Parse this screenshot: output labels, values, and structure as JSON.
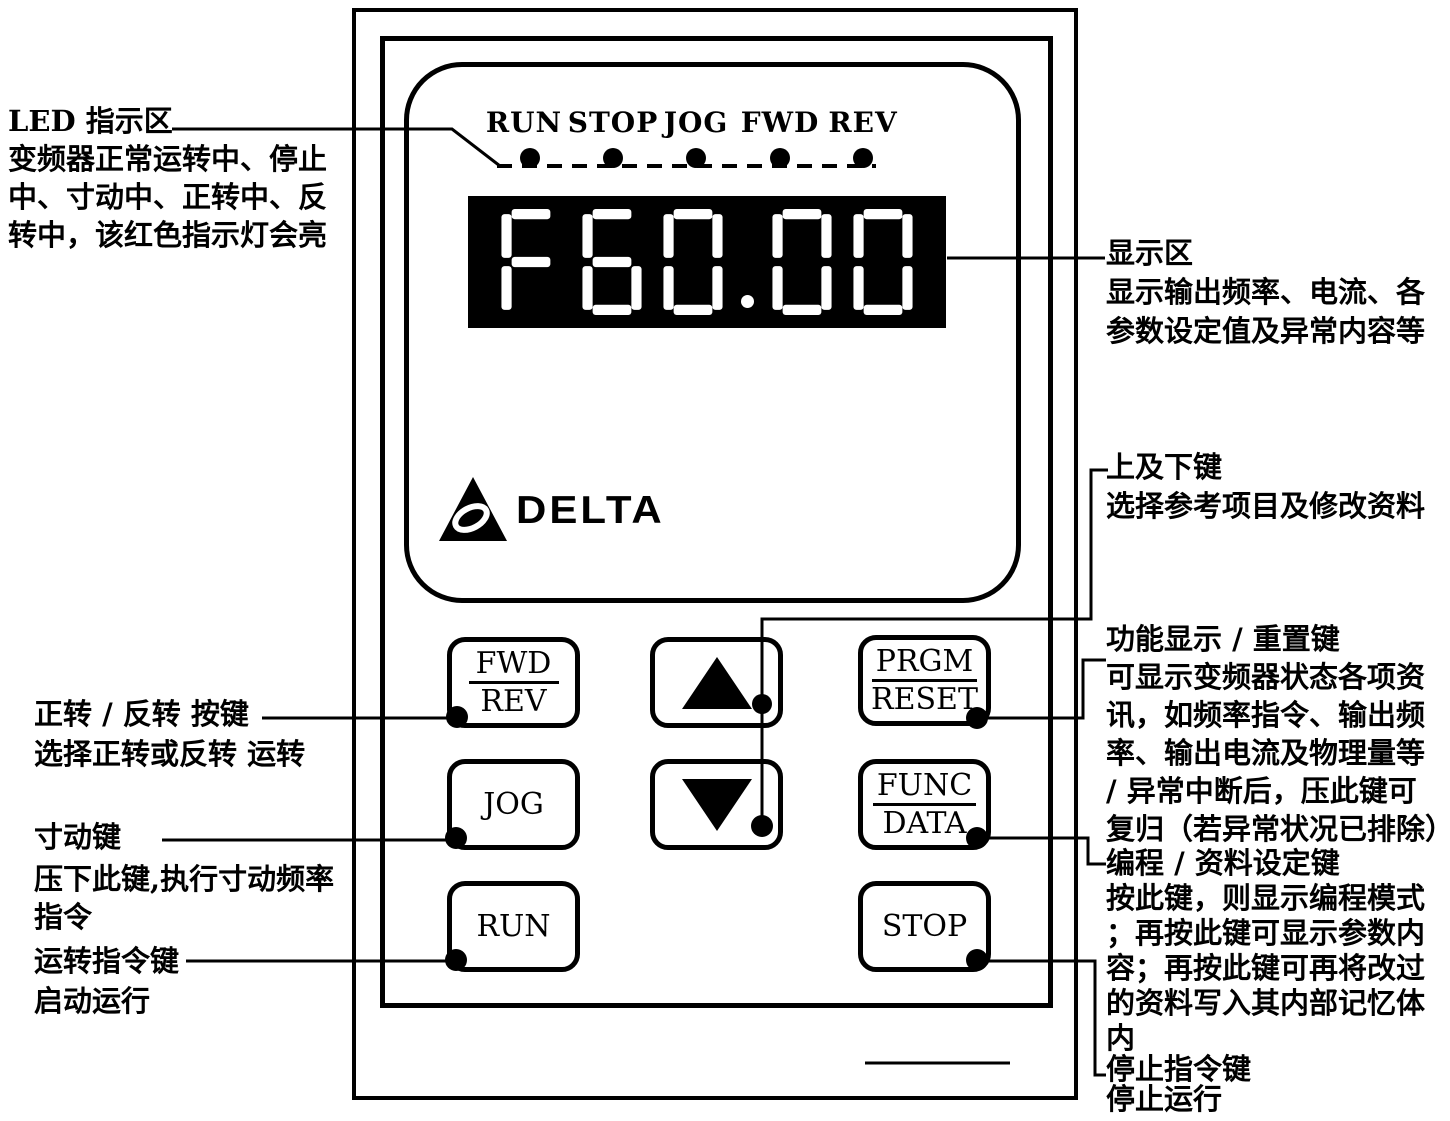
{
  "panel": {
    "led_labels": [
      "RUN",
      "STOP",
      "JOG",
      "FWD",
      "REV"
    ],
    "display_value": "F60.00",
    "brand": "DELTA",
    "keys": {
      "fwd_rev": {
        "top": "FWD",
        "bottom": "REV"
      },
      "prgm_reset": {
        "top": "PRGM",
        "bottom": "RESET"
      },
      "func_data": {
        "top": "FUNC",
        "bottom": "DATA"
      },
      "jog": {
        "label": "JOG"
      },
      "run": {
        "label": "RUN"
      },
      "stop": {
        "label": "STOP"
      },
      "up": {
        "icon": "up-arrow-icon"
      },
      "down": {
        "icon": "down-arrow-icon"
      }
    }
  },
  "annotations": {
    "led_area": {
      "title": "LED 指示区",
      "body": [
        "变频器正常运转中、停止",
        "中、寸动中、正转中、反",
        "转中，该红色指示灯会亮"
      ]
    },
    "display_area": {
      "title": "显示区",
      "body": [
        "显示输出频率、电流、各",
        "参数设定值及异常内容等"
      ]
    },
    "up_down": {
      "title": "上及下键",
      "body": [
        "选择参考项目及修改资料"
      ]
    },
    "fwd_rev": {
      "title": "正转 / 反转 按键",
      "body": [
        "选择正转或反转  运转"
      ]
    },
    "func_reset": {
      "title": "功能显示 / 重置键",
      "body": [
        "可显示变频器状态各项资",
        "讯，如频率指令、输出频",
        "率、输出电流及物理量等",
        "/ 异常中断后，压此键可",
        "复归（若异常状况已排除）"
      ]
    },
    "jog": {
      "title": "寸动键",
      "body": [
        "压下此键,执行寸动频率",
        "指令"
      ]
    },
    "prgm_data": {
      "title": "编程 / 资料设定键",
      "body": [
        "按此键，则显示编程模式",
        "；再按此键可显示参数内",
        "容；再按此键可再将改过",
        "的资料写入其内部记忆体",
        "内"
      ]
    },
    "run": {
      "title": "运转指令键",
      "body": [
        "启动运行"
      ]
    },
    "stop": {
      "title": "停止指令键",
      "body": [
        "停止运行"
      ]
    }
  },
  "colors": {
    "ink": "#000000",
    "paper": "#ffffff",
    "display_bg": "#000000",
    "display_segments": "#ffffff",
    "led_dot": "#000000"
  }
}
